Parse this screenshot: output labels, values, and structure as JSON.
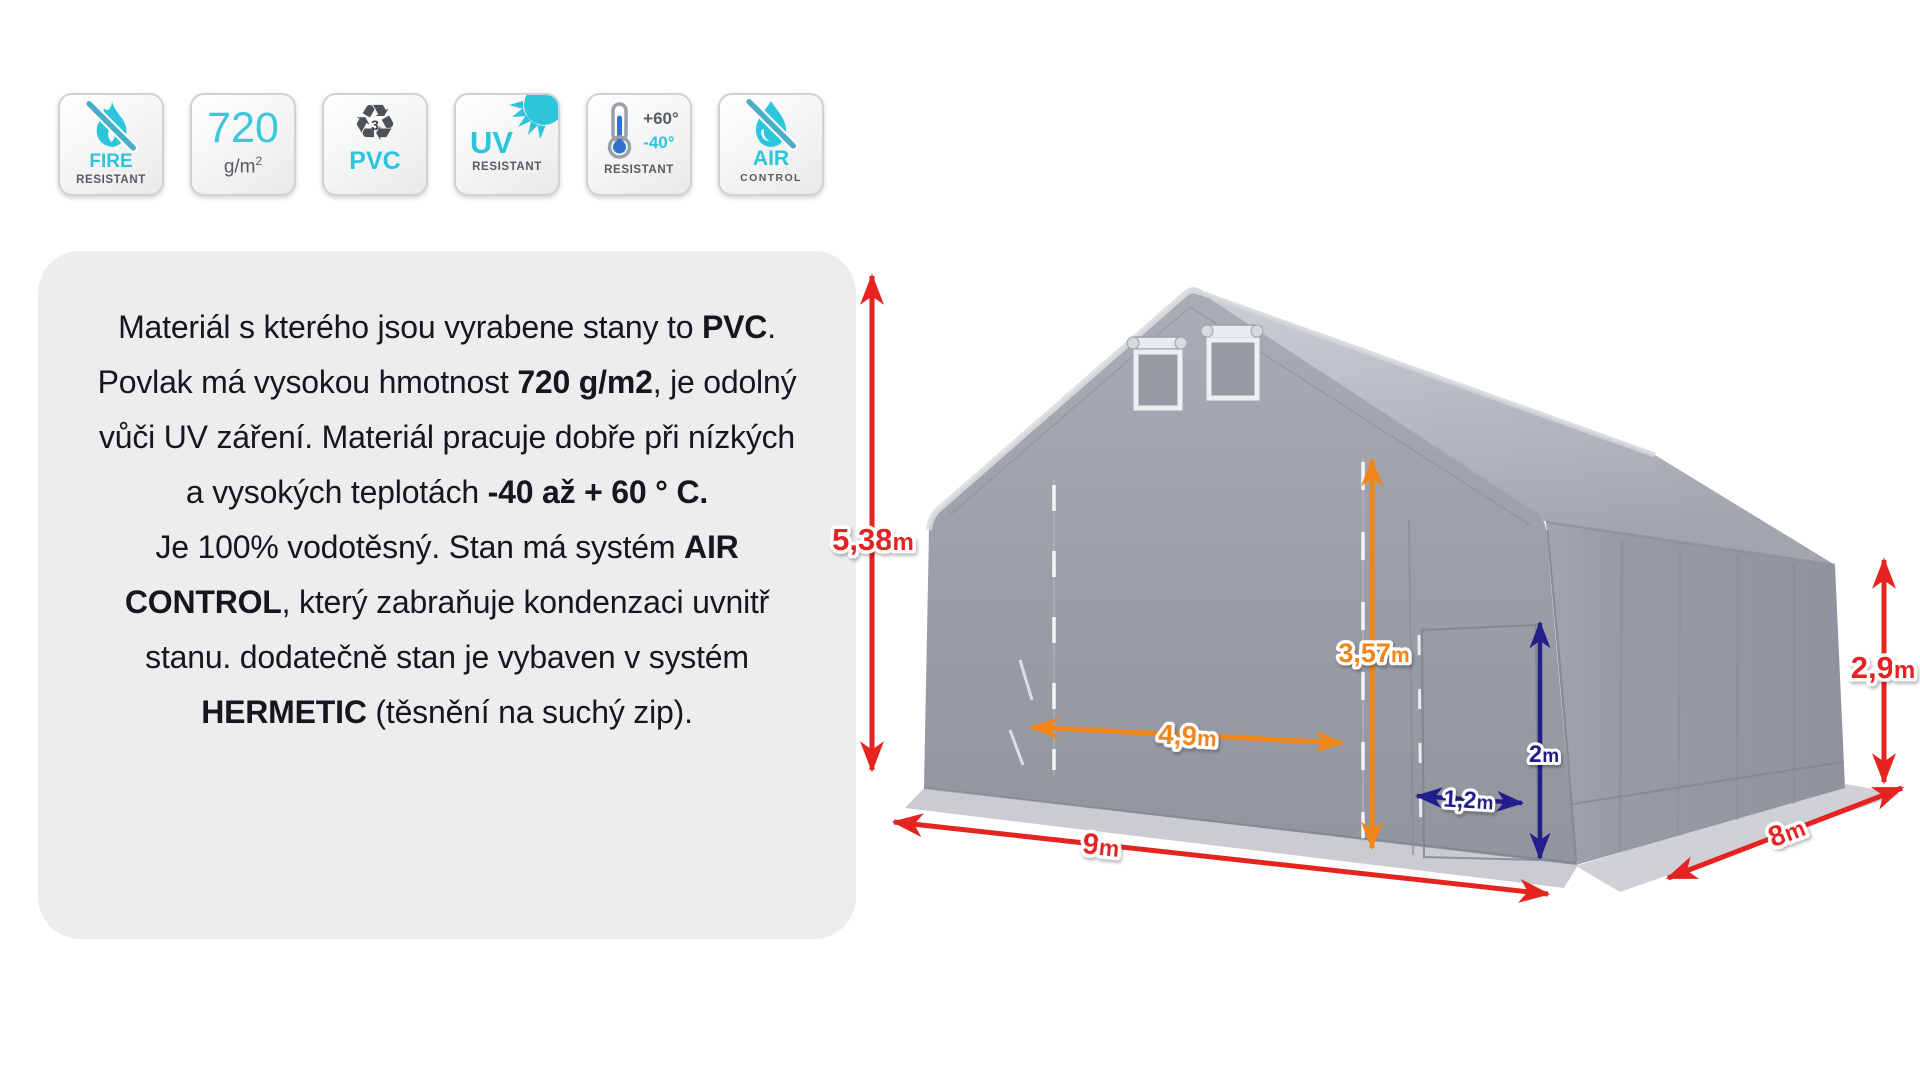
{
  "badges": [
    {
      "id": "fire-resistant",
      "line1": "FIRE",
      "line2": "RESISTANT",
      "icon": "flame-slash-icon"
    },
    {
      "id": "fabric-weight",
      "value": "720",
      "unit": "g/m",
      "unit_sup": "2"
    },
    {
      "id": "pvc-material",
      "recycle_number": "3",
      "label": "PVC",
      "icon": "recycle-icon"
    },
    {
      "id": "uv-resistant",
      "line1": "UV",
      "line2": "RESISTANT",
      "icon": "sun-icon"
    },
    {
      "id": "temperature-resistant",
      "high": "+60°",
      "low": "-40°",
      "label": "RESISTANT",
      "icon": "thermometer-icon"
    },
    {
      "id": "air-control",
      "line1": "AIR",
      "line2": "CONTROL",
      "icon": "drop-slash-icon"
    }
  ],
  "description": {
    "segments": [
      {
        "text": "Materiál s kterého jsou vyrabene stany to ",
        "bold": false
      },
      {
        "text": "PVC",
        "bold": true
      },
      {
        "text": ". Povlak má vysokou hmotnost ",
        "bold": false
      },
      {
        "text": "720 g/m2",
        "bold": true
      },
      {
        "text": ", je odolný vůči UV záření. Materiál pracuje dobře při nízkých a vysokých teplotách ",
        "bold": false
      },
      {
        "text": "-40 až + 60 ° C.",
        "bold": true
      },
      {
        "text": "\nJe 100% vodotěsný. Stan má systém ",
        "bold": false
      },
      {
        "text": "AIR CONTROL",
        "bold": true
      },
      {
        "text": ", který zabraňuje kondenzaci uvnitř stanu. dodatečně stan je vybaven v systém ",
        "bold": false
      },
      {
        "text": "HERMETIC",
        "bold": true
      },
      {
        "text": " (těsnění na suchý zip).",
        "bold": false
      }
    ]
  },
  "diagram": {
    "subject": "PVC storage tent with dimension arrows",
    "dimensions": [
      {
        "id": "total-height",
        "num": "5,38",
        "unit": "m"
      },
      {
        "id": "front-width",
        "num": "9",
        "unit": "m"
      },
      {
        "id": "side-depth",
        "num": "8",
        "unit": "m"
      },
      {
        "id": "side-height",
        "num": "2,9",
        "unit": "m"
      },
      {
        "id": "entrance-height",
        "num": "3,57",
        "unit": "m"
      },
      {
        "id": "entrance-width",
        "num": "4,9",
        "unit": "m"
      },
      {
        "id": "door-height",
        "num": "2",
        "unit": "m"
      },
      {
        "id": "door-width",
        "num": "1,2",
        "unit": "m"
      }
    ]
  },
  "colors": {
    "accent_cyan": "#2cc5d9",
    "dim_red": "#e52420",
    "dim_orange": "#f08519",
    "dim_navy": "#221e8b",
    "tent_gray": "#9b9ea7",
    "panel_gray": "#ededef"
  }
}
